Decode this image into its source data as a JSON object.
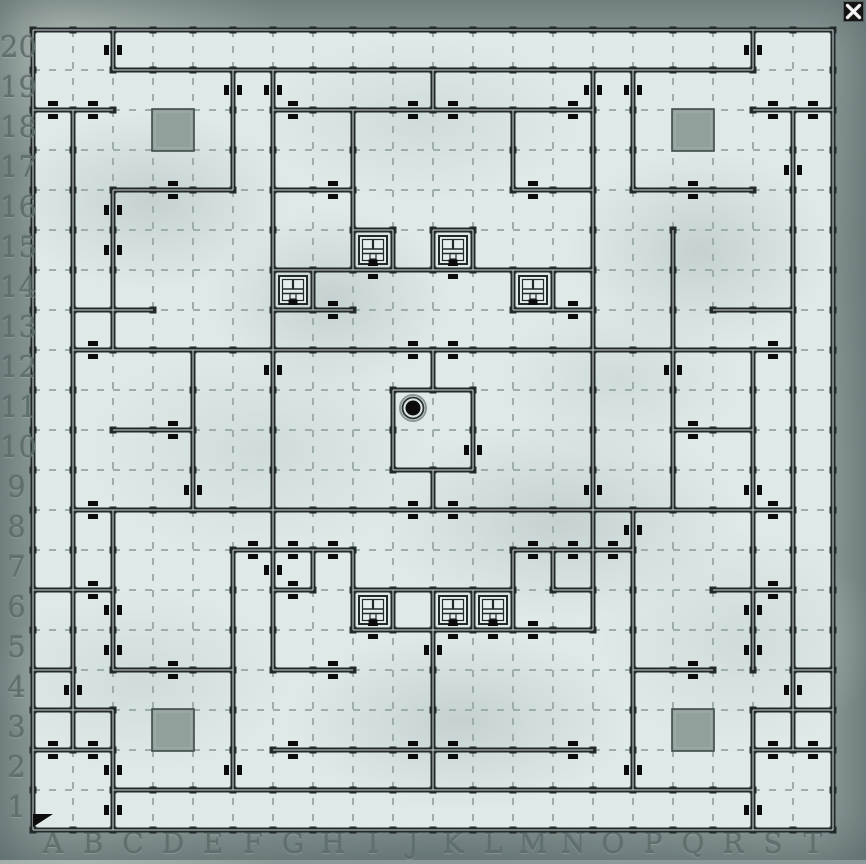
{
  "window": {
    "close_button": {
      "symbol": "X"
    }
  },
  "map": {
    "origin_x": 33,
    "origin_y": 30,
    "cell": 40,
    "cols": 20,
    "rows": 20,
    "col_labels": [
      "A",
      "B",
      "C",
      "D",
      "E",
      "F",
      "G",
      "H",
      "I",
      "J",
      "K",
      "L",
      "M",
      "N",
      "O",
      "P",
      "Q",
      "R",
      "S",
      "T"
    ],
    "row_labels": [
      20,
      19,
      18,
      17,
      16,
      15,
      14,
      13,
      12,
      11,
      10,
      9,
      8,
      7,
      6,
      5,
      4,
      3,
      2,
      1
    ],
    "colors": {
      "border_stone": "#8b9a98",
      "floor": "#dfe9e8",
      "grid": "#9cadac",
      "wall": "#23292b",
      "wall_core": "#c9d4d3",
      "door": "#0b0b0b",
      "slab": "#92a09b",
      "slab_border": "#3f4b4b",
      "label": "#5f6f6e",
      "marker": "#0c0c0c",
      "triangle": "#0d0d0d",
      "close_bg": "#141414",
      "close_x": "#eeeeee"
    },
    "walls_h": [
      {
        "j": 0,
        "i1": 0,
        "i2": 20,
        "doors": []
      },
      {
        "j": 1,
        "i1": 2,
        "i2": 18,
        "doors": []
      },
      {
        "j": 2,
        "i1": 0,
        "i2": 2,
        "doors": [
          "A",
          "B"
        ]
      },
      {
        "j": 2,
        "i1": 6,
        "i2": 14,
        "doors": [
          "G",
          "J",
          "K",
          "N"
        ]
      },
      {
        "j": 2,
        "i1": 18,
        "i2": 20,
        "doors": [
          "S",
          "T"
        ]
      },
      {
        "j": 4,
        "i1": 2,
        "i2": 5,
        "doors": [
          "D"
        ]
      },
      {
        "j": 4,
        "i1": 6,
        "i2": 8,
        "doors": [
          "H"
        ]
      },
      {
        "j": 4,
        "i1": 12,
        "i2": 14,
        "doors": [
          "M"
        ]
      },
      {
        "j": 4,
        "i1": 15,
        "i2": 18,
        "doors": [
          "Q"
        ]
      },
      {
        "j": 5,
        "i1": 8,
        "i2": 9,
        "doors": []
      },
      {
        "j": 5,
        "i1": 10,
        "i2": 11,
        "doors": []
      },
      {
        "j": 6,
        "i1": 6,
        "i2": 14,
        "doors": [
          "I",
          "K"
        ]
      },
      {
        "j": 7,
        "i1": 1,
        "i2": 3,
        "doors": []
      },
      {
        "j": 7,
        "i1": 6,
        "i2": 8,
        "doors": [
          "H"
        ]
      },
      {
        "j": 7,
        "i1": 12,
        "i2": 14,
        "doors": [
          "N"
        ]
      },
      {
        "j": 7,
        "i1": 17,
        "i2": 19,
        "doors": []
      },
      {
        "j": 8,
        "i1": 1,
        "i2": 19,
        "doors": [
          "B",
          "J",
          "K",
          "S"
        ]
      },
      {
        "j": 9,
        "i1": 9,
        "i2": 11,
        "doors": []
      },
      {
        "j": 10,
        "i1": 2,
        "i2": 4,
        "doors": [
          "D"
        ]
      },
      {
        "j": 10,
        "i1": 16,
        "i2": 18,
        "doors": [
          "Q"
        ]
      },
      {
        "j": 11,
        "i1": 9,
        "i2": 11,
        "doors": []
      },
      {
        "j": 12,
        "i1": 1,
        "i2": 19,
        "doors": [
          "B",
          "J",
          "K",
          "S"
        ]
      },
      {
        "j": 13,
        "i1": 5,
        "i2": 8,
        "doors": [
          "F",
          "G",
          "H"
        ]
      },
      {
        "j": 13,
        "i1": 12,
        "i2": 15,
        "doors": [
          "M",
          "N",
          "O"
        ]
      },
      {
        "j": 14,
        "i1": 0,
        "i2": 2,
        "doors": [
          "B"
        ]
      },
      {
        "j": 14,
        "i1": 6,
        "i2": 7,
        "doors": [
          "G"
        ]
      },
      {
        "j": 14,
        "i1": 8,
        "i2": 12,
        "doors": []
      },
      {
        "j": 14,
        "i1": 13,
        "i2": 14,
        "doors": []
      },
      {
        "j": 14,
        "i1": 17,
        "i2": 19,
        "doors": [
          "S"
        ]
      },
      {
        "j": 15,
        "i1": 8,
        "i2": 14,
        "doors": [
          "I",
          "K",
          "L",
          "M"
        ]
      },
      {
        "j": 16,
        "i1": 0,
        "i2": 1,
        "doors": []
      },
      {
        "j": 16,
        "i1": 2,
        "i2": 5,
        "doors": [
          "D"
        ]
      },
      {
        "j": 16,
        "i1": 6,
        "i2": 8,
        "doors": [
          "H"
        ]
      },
      {
        "j": 16,
        "i1": 15,
        "i2": 17,
        "doors": [
          "Q"
        ]
      },
      {
        "j": 16,
        "i1": 19,
        "i2": 20,
        "doors": []
      },
      {
        "j": 17,
        "i1": 0,
        "i2": 2,
        "doors": []
      },
      {
        "j": 17,
        "i1": 18,
        "i2": 20,
        "doors": []
      },
      {
        "j": 18,
        "i1": 0,
        "i2": 2,
        "doors": [
          "A",
          "B"
        ]
      },
      {
        "j": 18,
        "i1": 6,
        "i2": 14,
        "doors": [
          "G",
          "J",
          "K",
          "N"
        ]
      },
      {
        "j": 18,
        "i1": 18,
        "i2": 20,
        "doors": [
          "S",
          "T"
        ]
      },
      {
        "j": 19,
        "i1": 2,
        "i2": 18,
        "doors": []
      },
      {
        "j": 20,
        "i1": 0,
        "i2": 20,
        "doors": []
      }
    ],
    "walls_v": [
      {
        "i": 0,
        "j1": 0,
        "j2": 20,
        "doors": []
      },
      {
        "i": 1,
        "j1": 2,
        "j2": 18,
        "doors": [
          4
        ]
      },
      {
        "i": 2,
        "j1": 0,
        "j2": 1,
        "doors": [
          20
        ]
      },
      {
        "i": 2,
        "j1": 4,
        "j2": 8,
        "doors": [
          16,
          15
        ]
      },
      {
        "i": 2,
        "j1": 12,
        "j2": 16,
        "doors": [
          6,
          5
        ]
      },
      {
        "i": 2,
        "j1": 17,
        "j2": 20,
        "doors": [
          2,
          1
        ]
      },
      {
        "i": 4,
        "j1": 8,
        "j2": 12,
        "doors": [
          9
        ]
      },
      {
        "i": 5,
        "j1": 1,
        "j2": 4,
        "doors": [
          19
        ]
      },
      {
        "i": 5,
        "j1": 13,
        "j2": 19,
        "doors": [
          2
        ]
      },
      {
        "i": 6,
        "j1": 1,
        "j2": 16,
        "doors": [
          19,
          12,
          7
        ]
      },
      {
        "i": 7,
        "j1": 6,
        "j2": 7,
        "doors": []
      },
      {
        "i": 7,
        "j1": 13,
        "j2": 14,
        "doors": []
      },
      {
        "i": 8,
        "j1": 2,
        "j2": 6,
        "doors": []
      },
      {
        "i": 8,
        "j1": 13,
        "j2": 15,
        "doors": []
      },
      {
        "i": 9,
        "j1": 5,
        "j2": 6,
        "doors": []
      },
      {
        "i": 9,
        "j1": 9,
        "j2": 11,
        "doors": []
      },
      {
        "i": 9,
        "j1": 14,
        "j2": 15,
        "doors": []
      },
      {
        "i": 10,
        "j1": 1,
        "j2": 2,
        "doors": []
      },
      {
        "i": 10,
        "j1": 5,
        "j2": 6,
        "doors": []
      },
      {
        "i": 10,
        "j1": 8,
        "j2": 9,
        "doors": []
      },
      {
        "i": 10,
        "j1": 11,
        "j2": 12,
        "doors": []
      },
      {
        "i": 10,
        "j1": 14,
        "j2": 19,
        "doors": [
          5
        ]
      },
      {
        "i": 11,
        "j1": 5,
        "j2": 6,
        "doors": []
      },
      {
        "i": 11,
        "j1": 9,
        "j2": 11,
        "doors": [
          10
        ]
      },
      {
        "i": 11,
        "j1": 14,
        "j2": 15,
        "doors": []
      },
      {
        "i": 12,
        "j1": 2,
        "j2": 4,
        "doors": []
      },
      {
        "i": 12,
        "j1": 6,
        "j2": 7,
        "doors": []
      },
      {
        "i": 12,
        "j1": 13,
        "j2": 15,
        "doors": []
      },
      {
        "i": 13,
        "j1": 6,
        "j2": 7,
        "doors": []
      },
      {
        "i": 13,
        "j1": 13,
        "j2": 14,
        "doors": []
      },
      {
        "i": 14,
        "j1": 1,
        "j2": 15,
        "doors": [
          19,
          9
        ]
      },
      {
        "i": 15,
        "j1": 1,
        "j2": 4,
        "doors": [
          19
        ]
      },
      {
        "i": 15,
        "j1": 12,
        "j2": 19,
        "doors": [
          8,
          2
        ]
      },
      {
        "i": 16,
        "j1": 5,
        "j2": 12,
        "doors": [
          12
        ]
      },
      {
        "i": 18,
        "j1": 0,
        "j2": 1,
        "doors": [
          20
        ]
      },
      {
        "i": 18,
        "j1": 8,
        "j2": 16,
        "doors": [
          9,
          6,
          5
        ]
      },
      {
        "i": 18,
        "j1": 17,
        "j2": 20,
        "doors": [
          1
        ]
      },
      {
        "i": 19,
        "j1": 2,
        "j2": 18,
        "doors": [
          17,
          4
        ]
      },
      {
        "i": 20,
        "j1": 0,
        "j2": 20,
        "doors": []
      }
    ],
    "stairs": [
      "G14",
      "I15",
      "K15",
      "M14",
      "I6",
      "K6",
      "L6"
    ],
    "slabs": [
      "D18",
      "Q18",
      "D3",
      "Q3"
    ],
    "marker": {
      "cell": "J11",
      "type": "well"
    },
    "start_triangle": {
      "cell": "A1"
    }
  }
}
